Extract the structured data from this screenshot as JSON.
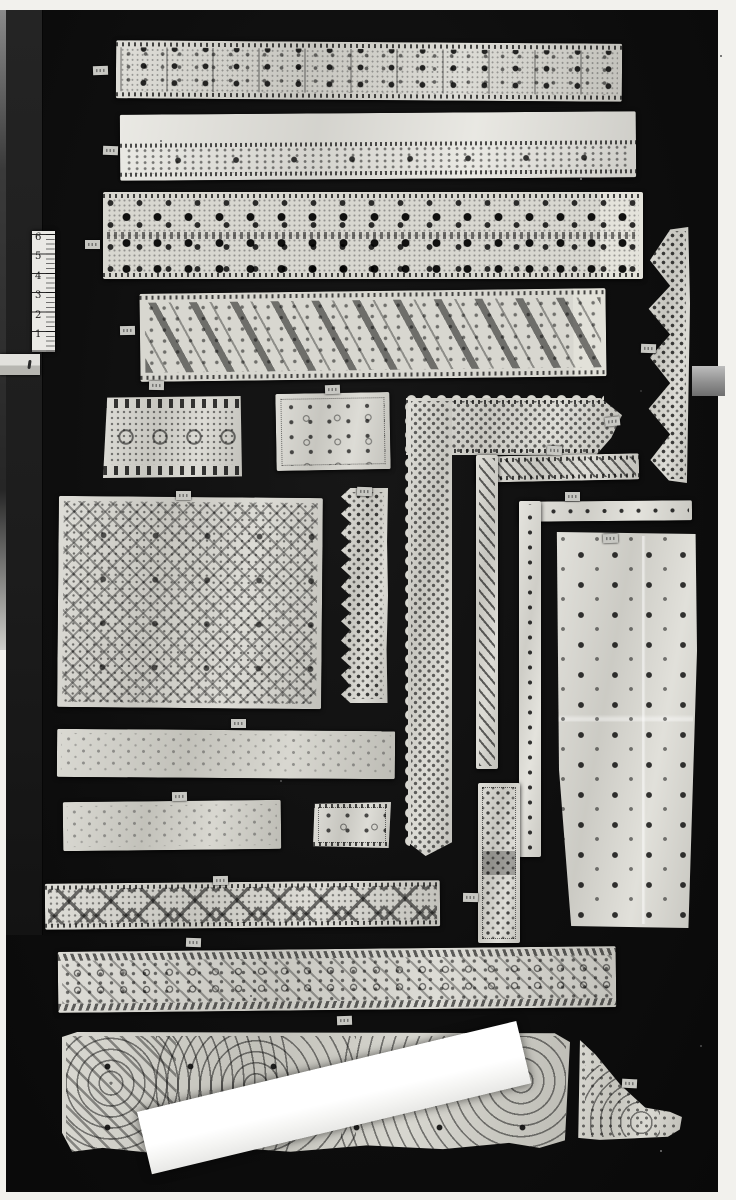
{
  "description": "Black-and-white archival photograph of lace and cutwork embroidery fragments pinned to a black display board, with a small inch ruler at left, tiny blank paper specimen tags beside each piece, a strip of gray tape at the right margin, and a bright blank paper strip lying diagonally across the bottom flounce.",
  "ruler": {
    "marks": [
      "6",
      "5",
      "4",
      "3",
      "2",
      "1"
    ],
    "unit_count": 6
  },
  "tags": {
    "count": 20,
    "legible_text": ""
  },
  "colors": {
    "photo_margin": "#f2f1ed",
    "board": "#0e0e0e",
    "lace": "#d8d7d0",
    "bright_strip": "#ffffff",
    "tag": "#c7c7c2",
    "tape": "#9b9b9b"
  },
  "pieces": [
    {
      "name": "lace-band-1",
      "form": "wide horizontal border of squared compartments with rosette cutwork"
    },
    {
      "name": "lace-band-2",
      "form": "horizontal band, plain upper half, floral cutwork row below"
    },
    {
      "name": "lace-band-3",
      "form": "wide horizontal band of dense dark geometric cutwork"
    },
    {
      "name": "lace-band-4",
      "form": "horizontal band with diagonal bars and dotted diamond medallions"
    },
    {
      "name": "lace-panel-wave",
      "form": "trapezoidal panel, meander wave between starred borders"
    },
    {
      "name": "lace-panel-small",
      "form": "small rectangle with scattered rosette cutwork"
    },
    {
      "name": "lace-edging-zigzag-right",
      "form": "vertical edging with deep zigzag scallops"
    },
    {
      "name": "lace-corner-large",
      "form": "L-shaped border corner with picot scallop edges"
    },
    {
      "name": "lace-corner-narrow",
      "form": "narrow L-shaped insertion with diagonal slashes"
    },
    {
      "name": "lace-corner-tape",
      "form": "narrow L-shaped tape with spaced eyelets"
    },
    {
      "name": "lace-panel-lattice",
      "form": "large panel of interlaced knotwork lattice"
    },
    {
      "name": "lace-band-zigzag-mid",
      "form": "vertical band with sawtooth edge and dotted grid"
    },
    {
      "name": "lace-cloth-right",
      "form": "long cloth panel, scattered square motifs and fold creases"
    },
    {
      "name": "lace-band-8",
      "form": "faint patterned horizontal band"
    },
    {
      "name": "lace-band-9",
      "form": "faint patterned horizontal band"
    },
    {
      "name": "lace-panel-tiny",
      "form": "small trapezoid with cross motifs"
    },
    {
      "name": "lace-panel-vertical",
      "form": "small vertical rectangle, dotted frame and crosses"
    },
    {
      "name": "lace-band-crosses",
      "form": "horizontal band of large dotted X motifs"
    },
    {
      "name": "lace-band-scroll",
      "form": "long band of rings and rosettes between rope borders"
    },
    {
      "name": "lace-flounce-spirals",
      "form": "deep bottom flounce with dotted spiral medallions"
    },
    {
      "name": "blank-strip",
      "form": "bright blank paper strip laid diagonally over the flounce"
    },
    {
      "name": "lace-fragment-triangle",
      "form": "triangular fragment with trailing scalloped tail"
    }
  ]
}
